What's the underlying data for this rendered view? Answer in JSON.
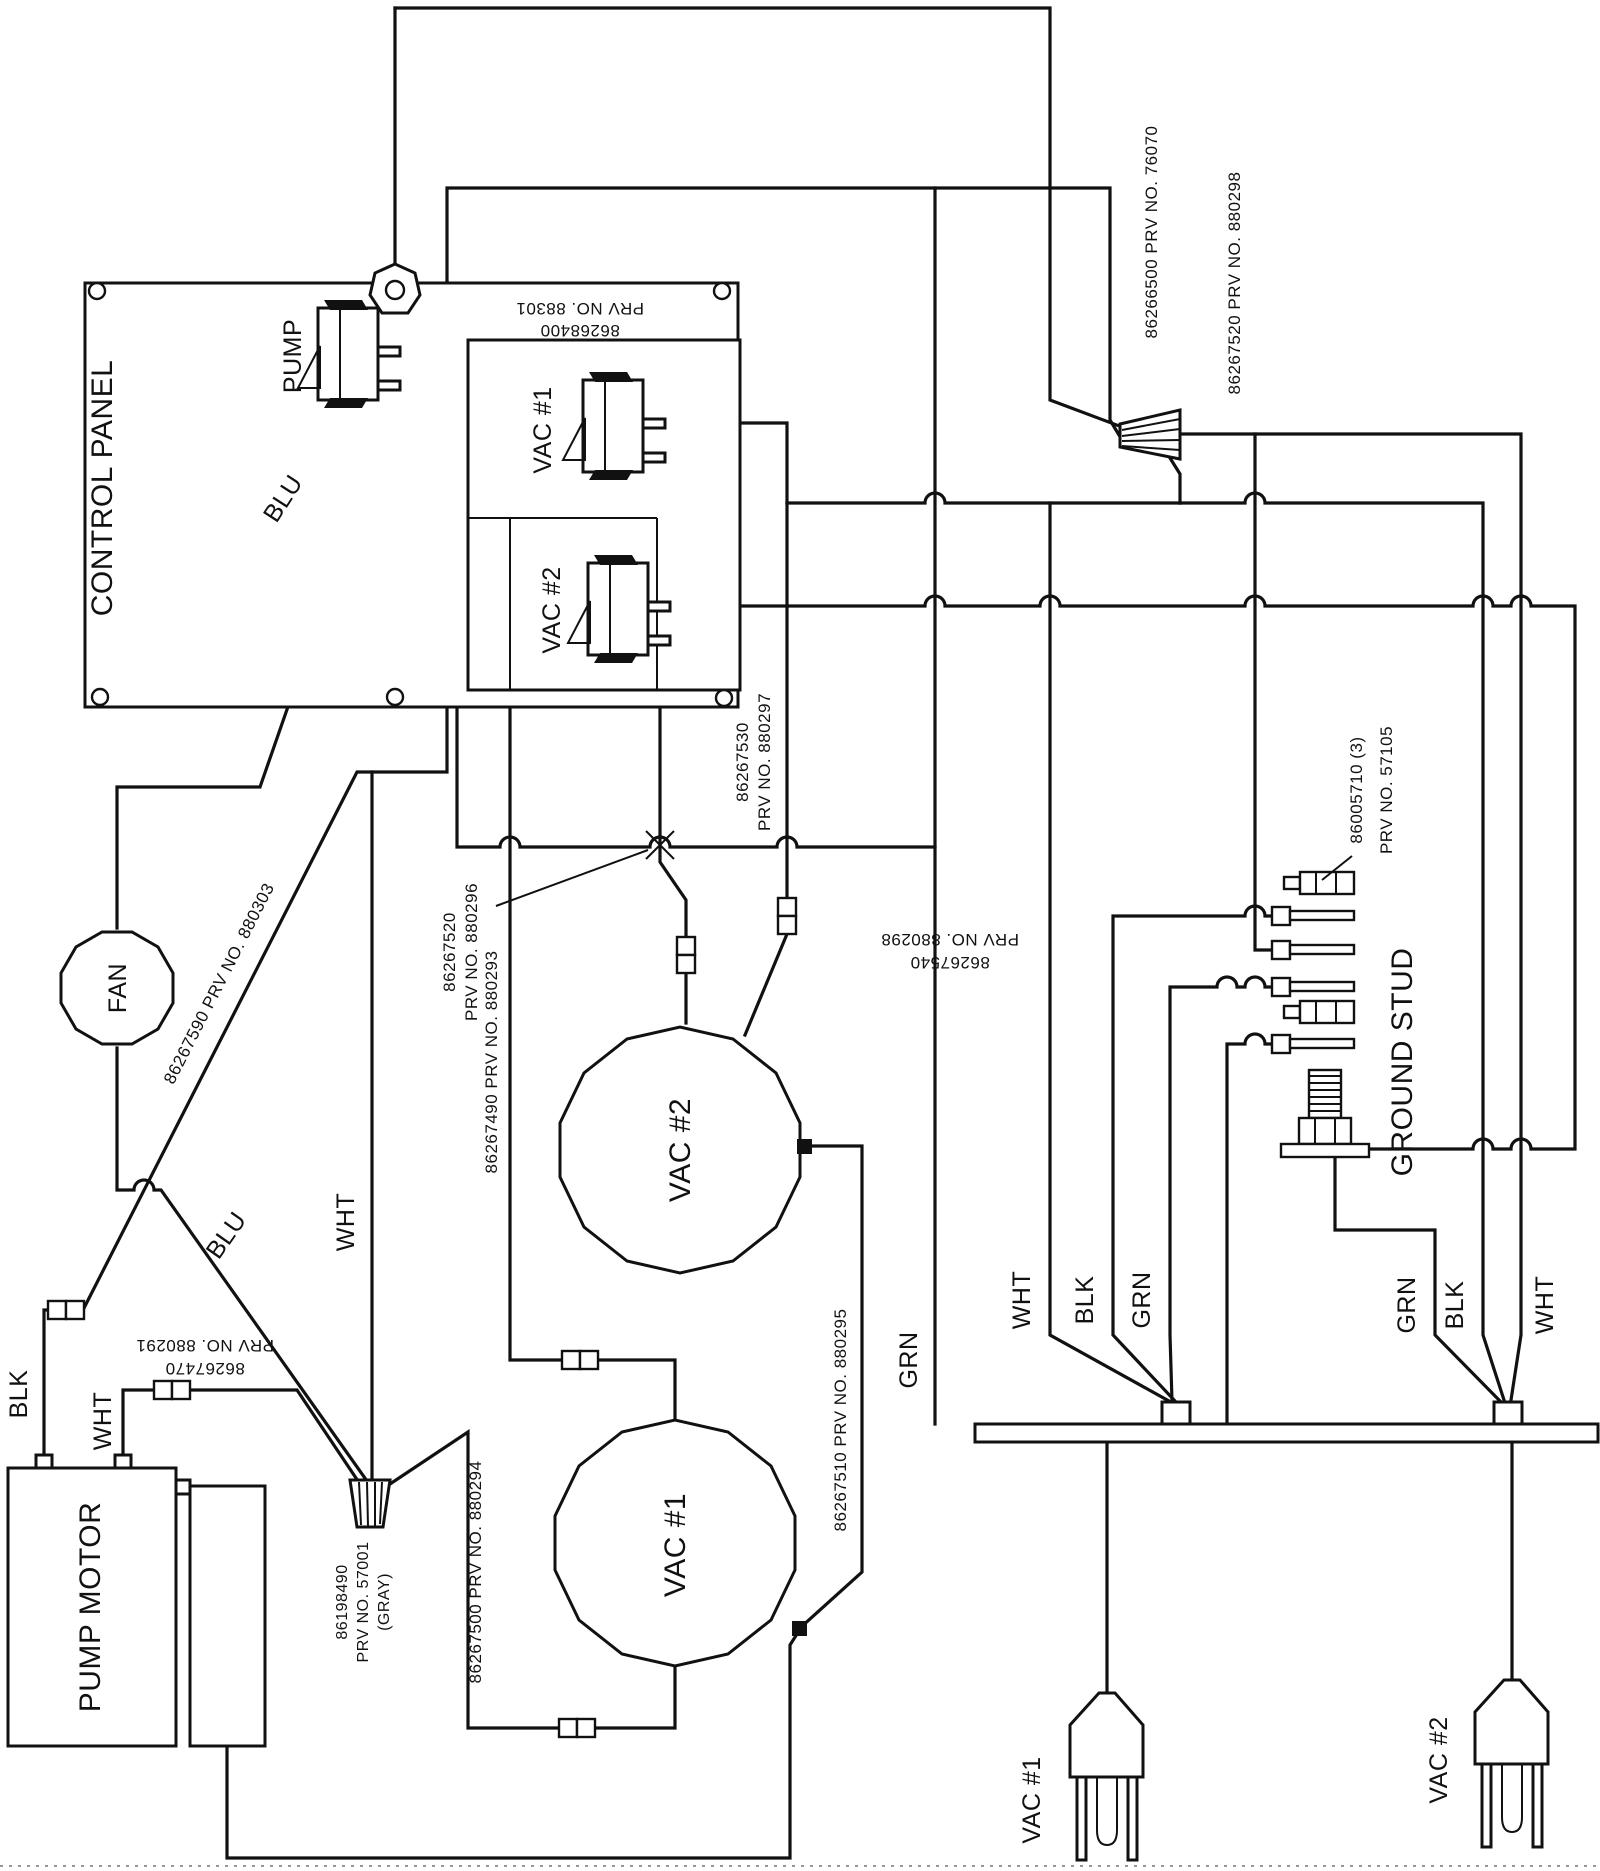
{
  "diagram": {
    "kind": "electrical wiring schematic (rotated 90°)",
    "device": "vacuum / pump system wiring"
  },
  "labels": {
    "control_panel": "CONTROL PANEL",
    "pump_switch": "PUMP",
    "vac1_switch": "VAC #1",
    "vac2_switch": "VAC #2",
    "panel_harness_num": "86268400",
    "panel_harness_prv": "PRV NO. 88301",
    "blu_top": "BLU",
    "blu_bottom": "BLU",
    "wire_880303": "86267590  PRV NO. 880303",
    "wht_mid": "WHT",
    "blk_motor": "BLK",
    "wht_motor": "WHT",
    "wire_880291_num": "86267470",
    "wire_880291_prv": "PRV NO. 880291",
    "nut_gray_num": "86198490",
    "nut_gray_prv": "PRV NO. 57001",
    "nut_gray_color": "(GRAY)",
    "pump_motor": "PUMP MOTOR",
    "fan": "FAN",
    "wire_880294": "86267500  PRV NO. 880294",
    "wire_880293": "86267490  PRV NO. 880293",
    "wire_880296_num": "86267520",
    "wire_880296_prv": "PRV NO. 880296",
    "wire_880297_num": "86267530",
    "wire_880297_prv": "PRV NO. 880297",
    "wire_880298b_num": "86267540",
    "wire_880298b_prv": "PRV NO. 880298",
    "vac2_motor": "VAC  #2",
    "vac1_motor": "VAC  #1",
    "wire_880295": "86267510  PRV NO. 880295",
    "grn_trunk": "GRN",
    "wht_left": "WHT",
    "blk_left": "BLK",
    "grn_left": "GRN",
    "grn_right": "GRN",
    "blk_right": "BLK",
    "wht_right": "WHT",
    "wire_76070": "86266500  PRV NO. 76070",
    "wire_880298": "86267520  PRV NO. 880298",
    "ring_terms_num": "86005710 (3)",
    "ring_terms_prv": "PRV NO. 57105",
    "ground_stud": "GROUND STUD",
    "vac1_plug": "VAC  #1",
    "vac2_plug": "VAC  #2"
  }
}
